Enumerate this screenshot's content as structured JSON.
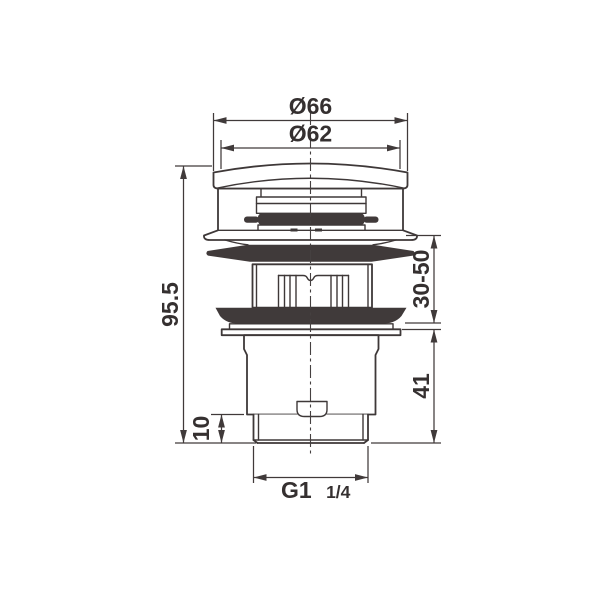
{
  "drawing": {
    "subject": "pop-up basin waste valve, front section technical drawing",
    "dimensions": {
      "cap_outer_diameter": "Ø66",
      "cap_top_diameter": "Ø62",
      "total_height": "95.5",
      "clamping_range": "30-50",
      "lower_body_height": "41",
      "thread_length": "10",
      "thread_size_main": "G1",
      "thread_size_fraction": "1/4"
    },
    "colors": {
      "line": "#3e3838",
      "dimension_line": "#403a3a",
      "text": "#353030",
      "seal_fill": "#332d2d",
      "background": "#ffffff"
    }
  }
}
